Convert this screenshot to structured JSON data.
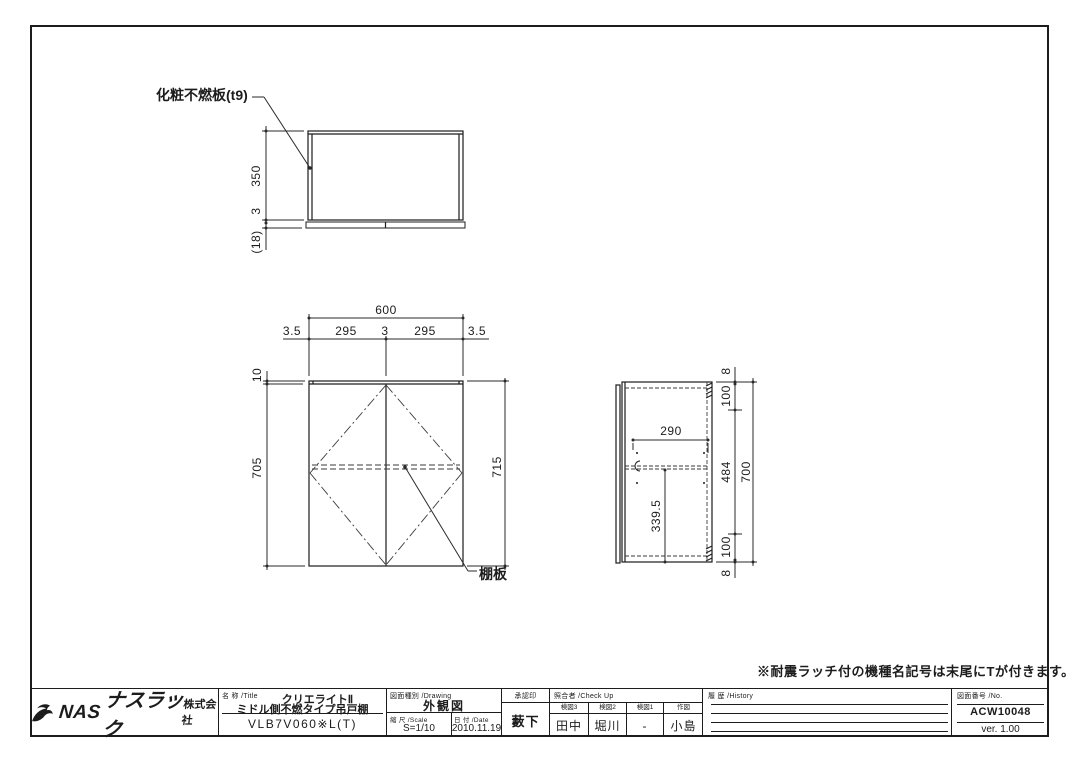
{
  "colors": {
    "ink": "#1c1c1c",
    "background": "#ffffff"
  },
  "annotations": {
    "finish_panel_callout": "化粧不燃板(t9)",
    "shelf_callout": "棚板",
    "footnote": "※耐震ラッチ付の機種名記号は末尾にTが付きます。"
  },
  "top_view": {
    "dim_depth": "350",
    "dim_gap": "3",
    "dim_door_thickness": "(18)"
  },
  "front_view": {
    "dim_width_total": "600",
    "dim_edge_left": "3.5",
    "dim_door_left": "295",
    "dim_center_gap": "3",
    "dim_door_right": "295",
    "dim_edge_right": "3.5",
    "dim_top_band": "10",
    "dim_body_height": "705",
    "dim_total_height": "715"
  },
  "side_view": {
    "dim_shelf_depth": "290",
    "dim_shelf_height": "339.5",
    "dim_top_edge": "8",
    "dim_top_offset": "100",
    "dim_mid_span": "484",
    "dim_bottom_offset": "100",
    "dim_bottom_edge": "8",
    "dim_total_height": "700"
  },
  "title_block": {
    "logo": {
      "nas": "NAS",
      "brand": "ナスラック",
      "suffix": "株式会社"
    },
    "name": {
      "header": "名 称 /Title",
      "series": "クリエライトⅡ",
      "product": "ミドル側不燃タイプ吊戸棚",
      "model": "VLB7V060※L(T)"
    },
    "drawing": {
      "header": "図面種別 /Drawing",
      "value": "外観図"
    },
    "scale": {
      "header": "縮 尺 /Scale",
      "value": "S=1/10"
    },
    "date": {
      "header": "日 付 /Date",
      "value": "2010.11.19"
    },
    "approval": {
      "header": "承認印",
      "value": "藪下"
    },
    "checkup": {
      "header": "照合者 /Check Up",
      "columns": [
        {
          "label": "検図3",
          "value": "田中"
        },
        {
          "label": "検図2",
          "value": "堀川"
        },
        {
          "label": "検図1",
          "value": "-"
        },
        {
          "label": "作図",
          "value": "小島"
        }
      ]
    },
    "history": {
      "header": "履 歴 /History"
    },
    "number": {
      "header": "図面番号 /No.",
      "value": "ACW10048",
      "version": "ver. 1.00"
    }
  }
}
